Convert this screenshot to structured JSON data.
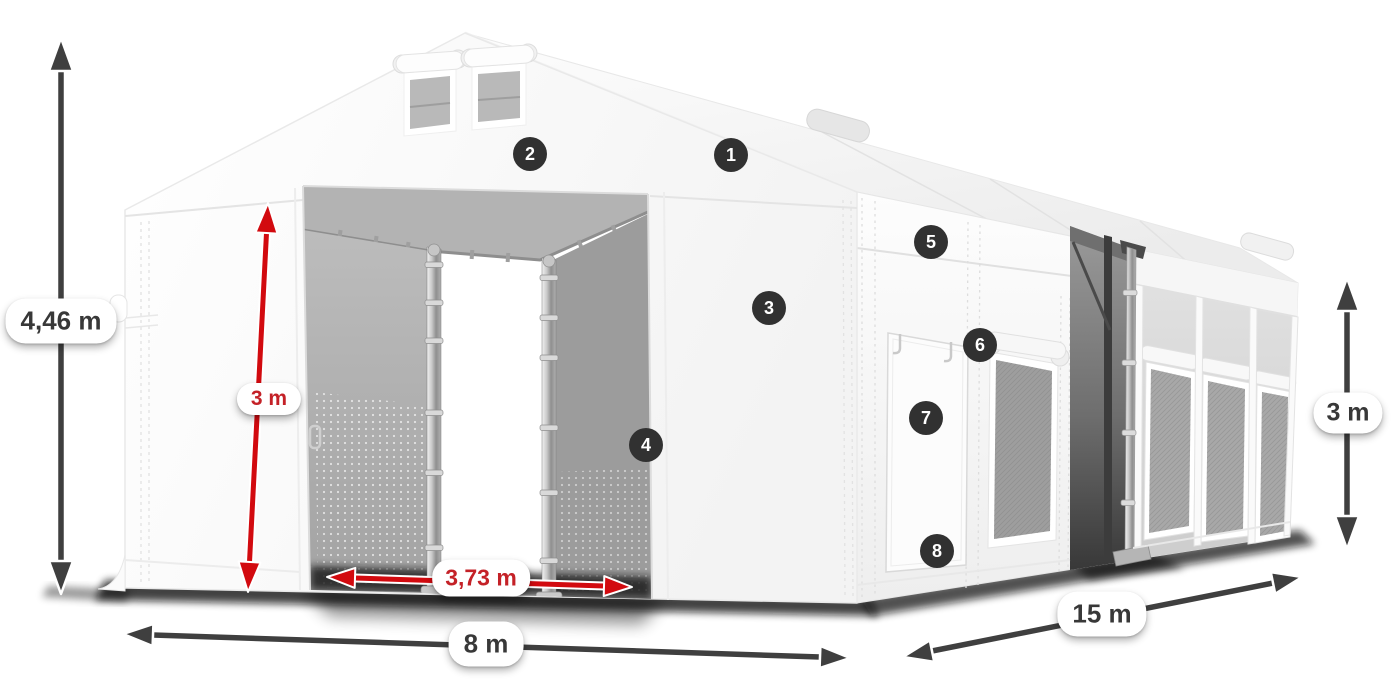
{
  "diagram": {
    "title": "tent-dimension-diagram",
    "markers": [
      {
        "number": "1"
      },
      {
        "number": "2"
      },
      {
        "number": "3"
      },
      {
        "number": "4"
      },
      {
        "number": "5"
      },
      {
        "number": "6"
      },
      {
        "number": "7"
      },
      {
        "number": "8"
      }
    ],
    "dimensions": {
      "total_height": {
        "label": "4,46 m"
      },
      "entrance_height": {
        "label": "3 m"
      },
      "entrance_width": {
        "label": "3,73 m"
      },
      "tent_width": {
        "label": "8 m"
      },
      "tent_length": {
        "label": "15 m"
      },
      "side_wall_height": {
        "label": "3 m"
      }
    },
    "colors": {
      "dimension_red": "#d20a0f",
      "dimension_dark": "#3f3f3f",
      "label_red_text": "#c42127",
      "label_dark_text": "#383838",
      "marker_background": "#313131",
      "marker_text": "#ffffff"
    }
  }
}
